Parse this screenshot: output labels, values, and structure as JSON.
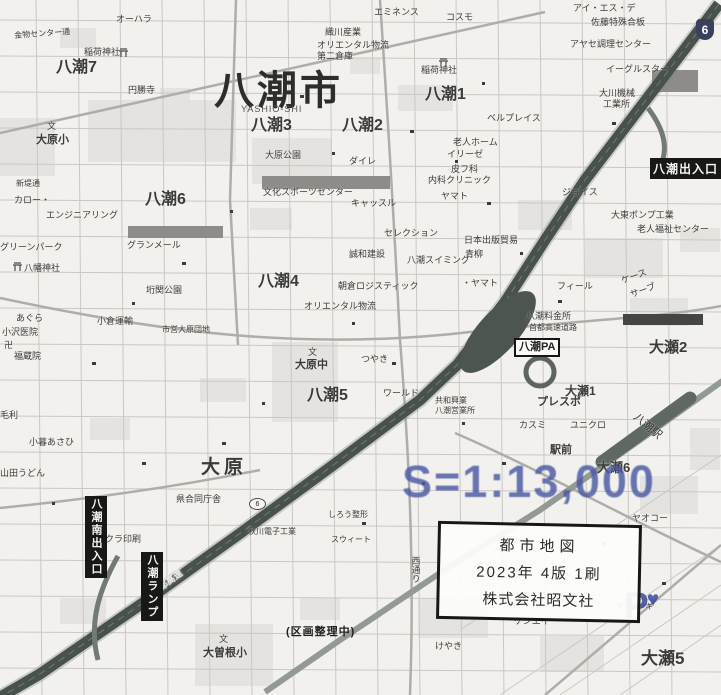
{
  "title": {
    "city": "八潮市",
    "romaji": "YASHIO-SHI"
  },
  "scale": {
    "text": "S=1:13,000",
    "color": "#4a58a4"
  },
  "credit_box": {
    "line1": "都市地図",
    "line2": "2023年 4版 1刷",
    "line3": "株式会社昭文社"
  },
  "note": {
    "text": "(区画整理中)"
  },
  "pa_box": {
    "text": "八潮PA"
  },
  "parking_logo": {
    "letter": "P",
    "heart": "♥",
    "color": "#3a489e"
  },
  "route_badges": [
    {
      "num": "6",
      "x": 696,
      "y": 19,
      "style": "shield"
    },
    {
      "num": "6",
      "x": 249,
      "y": 498,
      "style": "oval"
    }
  ],
  "interchange_boxes": [
    {
      "text": "八潮出入口",
      "x": 650,
      "y": 158,
      "orient": "h"
    },
    {
      "text": "八潮南出入口",
      "x": 85,
      "y": 496,
      "orient": "v"
    },
    {
      "text": "八潮ランプ",
      "x": 141,
      "y": 552,
      "orient": "v"
    }
  ],
  "labels": [
    {
      "t": "オーハラ",
      "x": 116,
      "y": 15
    },
    {
      "t": "稲荷神社",
      "x": 84,
      "y": 48
    },
    {
      "t": "円勝寺",
      "x": 128,
      "y": 86
    },
    {
      "t": "金物センター通",
      "x": 14,
      "y": 32,
      "s": 8,
      "r": -4
    },
    {
      "t": "八潮7",
      "x": 56,
      "y": 60,
      "s": 16,
      "b": 1
    },
    {
      "t": "文",
      "x": 47,
      "y": 122,
      "s": 9
    },
    {
      "t": "大原小",
      "x": 36,
      "y": 135,
      "s": 11,
      "b": 1
    },
    {
      "t": "新堤通",
      "x": 16,
      "y": 180,
      "s": 8
    },
    {
      "t": "八潮6",
      "x": 145,
      "y": 192,
      "s": 16,
      "b": 1
    },
    {
      "t": "カロー・",
      "x": 14,
      "y": 196
    },
    {
      "t": "エンジニアリング",
      "x": 46,
      "y": 211
    },
    {
      "t": "グリーンパーク",
      "x": 0,
      "y": 243
    },
    {
      "t": "八幡神社",
      "x": 24,
      "y": 264
    },
    {
      "t": "グランメール",
      "x": 127,
      "y": 241
    },
    {
      "t": "垳関公園",
      "x": 146,
      "y": 286
    },
    {
      "t": "小倉運輸",
      "x": 97,
      "y": 317
    },
    {
      "t": "市営大原団地",
      "x": 162,
      "y": 326,
      "s": 8
    },
    {
      "t": "あぐら",
      "x": 16,
      "y": 314
    },
    {
      "t": "小沢医院",
      "x": 2,
      "y": 328
    },
    {
      "t": "卍",
      "x": 4,
      "y": 341,
      "s": 9
    },
    {
      "t": "福蔵院",
      "x": 14,
      "y": 352
    },
    {
      "t": "毛利",
      "x": 0,
      "y": 411
    },
    {
      "t": "小暮あさひ",
      "x": 29,
      "y": 438
    },
    {
      "t": "山田うどん",
      "x": 0,
      "y": 469
    },
    {
      "t": "八潮3",
      "x": 251,
      "y": 118,
      "s": 16,
      "b": 1
    },
    {
      "t": "八潮2",
      "x": 342,
      "y": 118,
      "s": 16,
      "b": 1
    },
    {
      "t": "八潮1",
      "x": 425,
      "y": 87,
      "s": 16,
      "b": 1
    },
    {
      "t": "大原公園",
      "x": 265,
      "y": 151
    },
    {
      "t": "ダイレ",
      "x": 349,
      "y": 157
    },
    {
      "t": "エミネンス",
      "x": 374,
      "y": 8
    },
    {
      "t": "コスモ",
      "x": 446,
      "y": 13
    },
    {
      "t": "織川産業",
      "x": 325,
      "y": 28
    },
    {
      "t": "オリエンタル物流",
      "x": 317,
      "y": 41
    },
    {
      "t": "第二倉庫",
      "x": 317,
      "y": 52
    },
    {
      "t": "稲荷神社",
      "x": 421,
      "y": 66
    },
    {
      "t": "アイ・エス・デ",
      "x": 573,
      "y": 4
    },
    {
      "t": "佐藤特殊合板",
      "x": 591,
      "y": 18
    },
    {
      "t": "アヤセ調理センター",
      "x": 570,
      "y": 40
    },
    {
      "t": "イーグルスター",
      "x": 606,
      "y": 65
    },
    {
      "t": "大川機械",
      "x": 599,
      "y": 89
    },
    {
      "t": "工業所",
      "x": 603,
      "y": 100
    },
    {
      "t": "ベルプレイス",
      "x": 487,
      "y": 114
    },
    {
      "t": "老人ホーム",
      "x": 453,
      "y": 138
    },
    {
      "t": "イリーゼ",
      "x": 447,
      "y": 150
    },
    {
      "t": "皮フ科",
      "x": 451,
      "y": 165
    },
    {
      "t": "内科クリニック",
      "x": 428,
      "y": 176
    },
    {
      "t": "ヤマト",
      "x": 441,
      "y": 192
    },
    {
      "t": "ジョイス",
      "x": 562,
      "y": 188
    },
    {
      "t": "文化スポーツセンター",
      "x": 263,
      "y": 188
    },
    {
      "t": "キャッスル",
      "x": 351,
      "y": 199
    },
    {
      "t": "セレクション",
      "x": 384,
      "y": 229
    },
    {
      "t": "誠和建設",
      "x": 349,
      "y": 250
    },
    {
      "t": "八潮4",
      "x": 258,
      "y": 274,
      "s": 16,
      "b": 1
    },
    {
      "t": "朝倉ロジスティック",
      "x": 338,
      "y": 282
    },
    {
      "t": "オリエンタル物流",
      "x": 304,
      "y": 302
    },
    {
      "t": "八潮スイミング",
      "x": 407,
      "y": 256
    },
    {
      "t": "・ヤマト",
      "x": 462,
      "y": 279
    },
    {
      "t": "日本出版貿易",
      "x": 464,
      "y": 236
    },
    {
      "t": "青柳",
      "x": 465,
      "y": 250
    },
    {
      "t": "大東ポンプ工業",
      "x": 611,
      "y": 211
    },
    {
      "t": "老人福祉センター",
      "x": 637,
      "y": 225
    },
    {
      "t": "ケース",
      "x": 620,
      "y": 277,
      "r": -20
    },
    {
      "t": "サーブ",
      "x": 629,
      "y": 291,
      "r": -20
    },
    {
      "t": "フィール",
      "x": 557,
      "y": 282
    },
    {
      "t": "八潮料金所",
      "x": 526,
      "y": 312
    },
    {
      "t": "首都高速道路",
      "x": 529,
      "y": 324,
      "s": 8
    },
    {
      "t": "大瀬2",
      "x": 649,
      "y": 340,
      "s": 15,
      "b": 1
    },
    {
      "t": "大瀬1",
      "x": 565,
      "y": 385,
      "s": 12,
      "b": 1
    },
    {
      "t": "プレスポ",
      "x": 537,
      "y": 397,
      "s": 11,
      "b": 1
    },
    {
      "t": "カスミ",
      "x": 519,
      "y": 421
    },
    {
      "t": "ユニクロ",
      "x": 570,
      "y": 421
    },
    {
      "t": "駅前",
      "x": 550,
      "y": 445,
      "s": 11,
      "b": 1
    },
    {
      "t": "八潮駅",
      "x": 638,
      "y": 412,
      "s": 11,
      "r": 40,
      "c": "#2f2f2d"
    },
    {
      "t": "大瀬6",
      "x": 597,
      "y": 461,
      "s": 13,
      "b": 1
    },
    {
      "t": "共和興業",
      "x": 435,
      "y": 397,
      "s": 8
    },
    {
      "t": "八潮営業所",
      "x": 435,
      "y": 407,
      "s": 8
    },
    {
      "t": "つやき",
      "x": 361,
      "y": 355
    },
    {
      "t": "ワールド",
      "x": 383,
      "y": 389
    },
    {
      "t": "文",
      "x": 308,
      "y": 348,
      "s": 9
    },
    {
      "t": "大原中",
      "x": 295,
      "y": 360,
      "s": 11,
      "b": 1
    },
    {
      "t": "八潮5",
      "x": 307,
      "y": 388,
      "s": 16,
      "b": 1
    },
    {
      "t": "大原",
      "x": 201,
      "y": 458,
      "s": 19,
      "b": 1,
      "ls": 4
    },
    {
      "t": "県合同庁舎",
      "x": 176,
      "y": 495
    },
    {
      "t": "サクラ印刷",
      "x": 96,
      "y": 535
    },
    {
      "t": "しろう整形",
      "x": 328,
      "y": 511,
      "s": 8
    },
    {
      "t": "秋川電子工業",
      "x": 248,
      "y": 528,
      "s": 8
    },
    {
      "t": "スウィート",
      "x": 331,
      "y": 536,
      "s": 8
    },
    {
      "t": "西通り",
      "x": 410,
      "y": 556,
      "v": 1
    },
    {
      "t": "けやき",
      "x": 435,
      "y": 642
    },
    {
      "t": "ケンエイ",
      "x": 514,
      "y": 617
    },
    {
      "t": "K'Sデンキ",
      "x": 617,
      "y": 603,
      "s": 8
    },
    {
      "t": "ヤオコー",
      "x": 632,
      "y": 514
    },
    {
      "t": "大瀬5",
      "x": 641,
      "y": 650,
      "s": 17,
      "b": 1
    },
    {
      "t": "文",
      "x": 219,
      "y": 635,
      "s": 9
    },
    {
      "t": "大曽根小",
      "x": 203,
      "y": 648,
      "s": 11,
      "b": 1
    },
    {
      "t": "首都高速",
      "x": 150,
      "y": 590,
      "r": -36,
      "c": "#eceae6",
      "b": 1
    }
  ]
}
